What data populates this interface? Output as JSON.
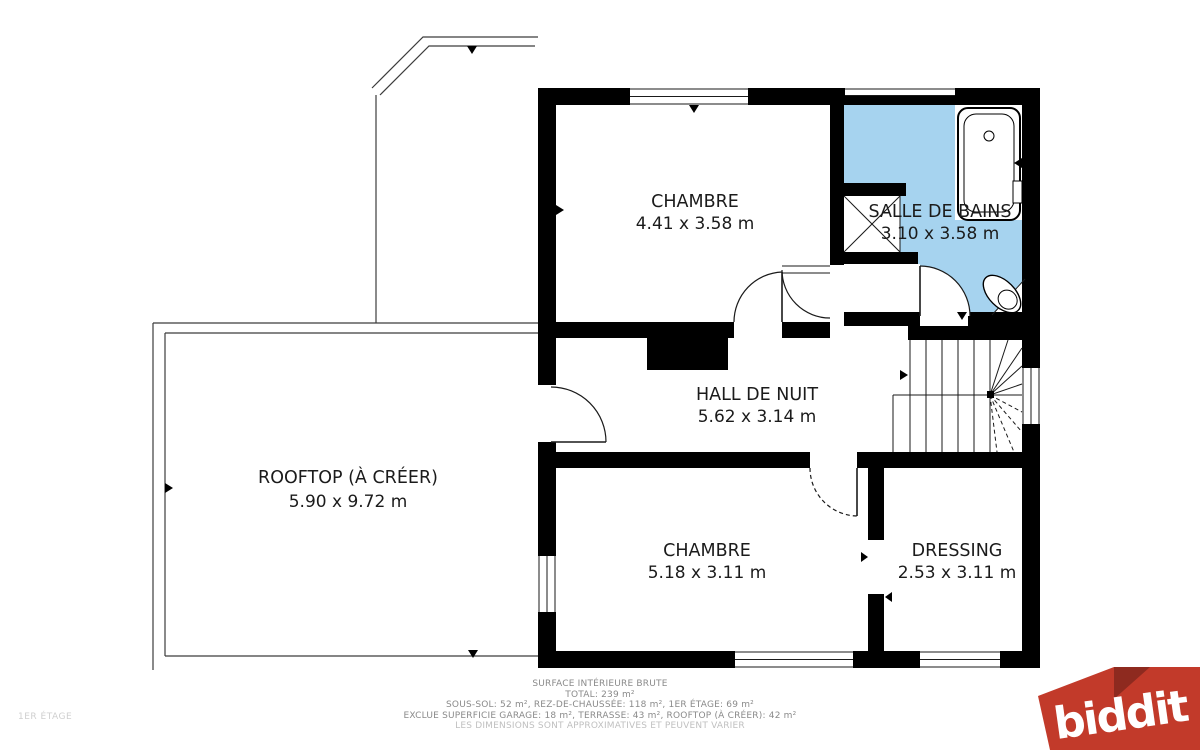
{
  "floor_plan": {
    "floor_label": "1ER ÉTAGE",
    "rooms": [
      {
        "id": "chambre-top",
        "name": "CHAMBRE",
        "dims": "4.41 x 3.58 m"
      },
      {
        "id": "salle-de-bains",
        "name": "SALLE DE BAINS",
        "dims": "3.10 x 3.58 m"
      },
      {
        "id": "hall-de-nuit",
        "name": "HALL DE NUIT",
        "dims": "5.62 x 3.14 m"
      },
      {
        "id": "rooftop",
        "name": "ROOFTOP (À CRÉER)",
        "dims": "5.90 x 9.72 m"
      },
      {
        "id": "chambre-bottom",
        "name": "CHAMBRE",
        "dims": "5.18 x 3.11 m"
      },
      {
        "id": "dressing",
        "name": "DRESSING",
        "dims": "2.53 x 3.11 m"
      }
    ],
    "colors": {
      "wall": "#000000",
      "bathroom": "#a6d3ef",
      "logo_red": "#c23a2a",
      "logo_fold": "#8e2a1f"
    }
  },
  "footer": {
    "line1": "SURFACE INTÉRIEURE BRUTE",
    "line2": "TOTAL: 239 m²",
    "line3": "SOUS-SOL: 52 m², REZ-DE-CHAUSSÉE: 118 m², 1ER ÉTAGE: 69 m²",
    "line4": "EXCLUE SUPERFICIE GARAGE: 18 m², TERRASSE: 43 m², ROOFTOP (À CRÉER): 42 m²",
    "line5": "LES DIMENSIONS SONT APPROXIMATIVES ET PEUVENT VARIER"
  },
  "logo": {
    "text": "biddit"
  }
}
